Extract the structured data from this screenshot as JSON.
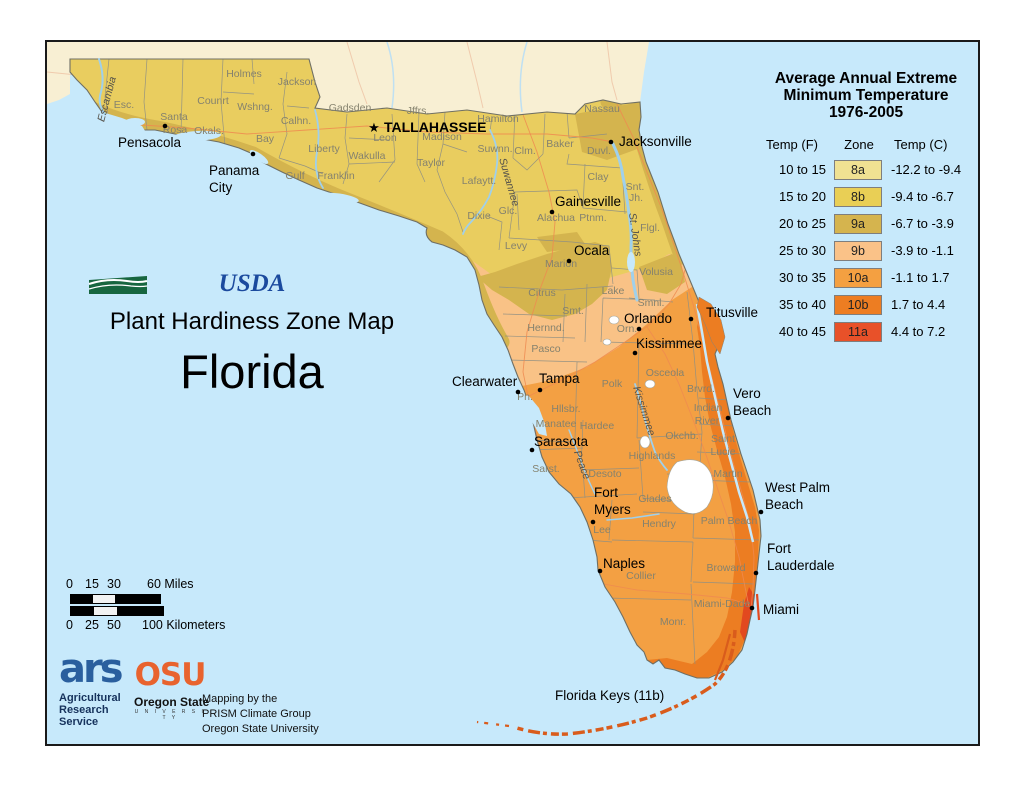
{
  "legend": {
    "title_lines": [
      "Average Annual Extreme",
      "Minimum Temperature",
      "1976-2005"
    ],
    "col_f": "Temp (F)",
    "col_zone": "Zone",
    "col_c": "Temp (C)",
    "rows": [
      {
        "f": "10 to 15",
        "zone": "8a",
        "c": "-12.2 to -9.4",
        "color": "#f0e192"
      },
      {
        "f": "15 to 20",
        "zone": "8b",
        "c": "-9.4 to -6.7",
        "color": "#e9cf55"
      },
      {
        "f": "20 to 25",
        "zone": "9a",
        "c": "-6.7 to -3.9",
        "color": "#d5b44e"
      },
      {
        "f": "25 to 30",
        "zone": "9b",
        "c": "-3.9 to -1.1",
        "color": "#fac288"
      },
      {
        "f": "30 to 35",
        "zone": "10a",
        "c": "-1.1 to 1.7",
        "color": "#f4a041"
      },
      {
        "f": "35 to 40",
        "zone": "10b",
        "c": "1.7 to 4.4",
        "color": "#ed7d22"
      },
      {
        "f": "40 to 45",
        "zone": "11a",
        "c": "4.4 to 7.2",
        "color": "#e85129"
      }
    ]
  },
  "titles": {
    "usda": "USDA",
    "map_title": "Plant Hardiness Zone Map",
    "state": "Florida"
  },
  "scalebar": {
    "miles": [
      "0",
      "15",
      "30",
      "60 Miles"
    ],
    "km": [
      "0",
      "25",
      "50",
      "100 Kilometers"
    ]
  },
  "credits": {
    "ars_glyph": "ars",
    "ars_lines": [
      "Agricultural",
      "Research",
      "Service"
    ],
    "osu": "OSU",
    "osu_sub": "Oregon State",
    "osu_univ": "U N I V E R S I T Y",
    "mapping_lines": [
      "Mapping by the",
      "PRISM Climate Group",
      "Oregon State University"
    ]
  },
  "map": {
    "colors": {
      "water": "#c7e9fb",
      "neighbor": "#f8efd3",
      "z8b": "#e9cd5f",
      "z9a": "#d4b44e",
      "z9b": "#f9c286",
      "z10a": "#f3a043",
      "z10b": "#ec7d22",
      "z11a": "#e2491f",
      "keys": "#d95c1c"
    },
    "capital": {
      "label": "TALLAHASSEE",
      "star": "★",
      "sx": 327,
      "sy": 90,
      "tx": 337,
      "ty": 90
    },
    "keys_label": {
      "label": "Florida Keys (11b)",
      "x": 508,
      "y": 658
    },
    "cities": [
      {
        "lines": [
          "Pensacola"
        ],
        "tx": 71,
        "ty": 105,
        "dot": {
          "x": 118,
          "y": 84
        }
      },
      {
        "lines": [
          "Panama",
          "City"
        ],
        "tx": 162,
        "ty": 133,
        "lh": 17,
        "dot": {
          "x": 206,
          "y": 112
        }
      },
      {
        "lines": [
          "Jacksonville"
        ],
        "tx": 572,
        "ty": 104,
        "dot": {
          "x": 564,
          "y": 100
        }
      },
      {
        "lines": [
          "Gainesville"
        ],
        "tx": 508,
        "ty": 164,
        "dot": {
          "x": 505,
          "y": 170
        }
      },
      {
        "lines": [
          "Ocala"
        ],
        "tx": 527,
        "ty": 213,
        "dot": {
          "x": 522,
          "y": 219
        }
      },
      {
        "lines": [
          "Titusville"
        ],
        "tx": 659,
        "ty": 275,
        "dot": {
          "x": 644,
          "y": 277
        }
      },
      {
        "lines": [
          "Orlando"
        ],
        "tx": 577,
        "ty": 281,
        "dot": {
          "x": 592,
          "y": 287
        }
      },
      {
        "lines": [
          "Kissimmee"
        ],
        "tx": 589,
        "ty": 306,
        "dot": {
          "x": 588,
          "y": 311
        }
      },
      {
        "lines": [
          "Clearwater"
        ],
        "tx": 405,
        "ty": 344,
        "dot": {
          "x": 471,
          "y": 350
        }
      },
      {
        "lines": [
          "Tampa"
        ],
        "tx": 492,
        "ty": 341,
        "dot": {
          "x": 493,
          "y": 348
        }
      },
      {
        "lines": [
          "Vero",
          "Beach"
        ],
        "tx": 686,
        "ty": 356,
        "lh": 17,
        "dot": {
          "x": 681,
          "y": 376
        }
      },
      {
        "lines": [
          "Sarasota"
        ],
        "tx": 487,
        "ty": 404,
        "dot": {
          "x": 485,
          "y": 408
        }
      },
      {
        "lines": [
          "Fort",
          "Myers"
        ],
        "tx": 547,
        "ty": 455,
        "lh": 17,
        "dot": {
          "x": 546,
          "y": 480
        }
      },
      {
        "lines": [
          "West Palm",
          "Beach"
        ],
        "tx": 718,
        "ty": 450,
        "lh": 17,
        "dot": {
          "x": 714,
          "y": 470
        }
      },
      {
        "lines": [
          "Naples"
        ],
        "tx": 556,
        "ty": 526,
        "dot": {
          "x": 553,
          "y": 529
        }
      },
      {
        "lines": [
          "Fort",
          "Lauderdale"
        ],
        "tx": 720,
        "ty": 511,
        "lh": 17,
        "dot": {
          "x": 709,
          "y": 531
        }
      },
      {
        "lines": [
          "Miami"
        ],
        "tx": 716,
        "ty": 572,
        "dot": {
          "x": 705,
          "y": 566
        }
      }
    ],
    "counties": [
      {
        "label": "Esc.",
        "x": 77,
        "y": 66
      },
      {
        "label": "Santa",
        "x": 127,
        "y": 78
      },
      {
        "label": "Rosa",
        "x": 128,
        "y": 91
      },
      {
        "label": "Okals.",
        "x": 162,
        "y": 92
      },
      {
        "label": "Counrt",
        "x": 166,
        "y": 62
      },
      {
        "label": "Holmes",
        "x": 197,
        "y": 35
      },
      {
        "label": "Wshng.",
        "x": 208,
        "y": 68
      },
      {
        "label": "Jackson",
        "x": 250,
        "y": 43
      },
      {
        "label": "Calhn.",
        "x": 249,
        "y": 82
      },
      {
        "label": "Gadsden",
        "x": 303,
        "y": 69
      },
      {
        "label": "Liberty",
        "x": 277,
        "y": 110
      },
      {
        "label": "Wakulla",
        "x": 320,
        "y": 117
      },
      {
        "label": "Bay",
        "x": 218,
        "y": 100
      },
      {
        "label": "Gulf",
        "x": 248,
        "y": 137
      },
      {
        "label": "Franklin",
        "x": 289,
        "y": 137
      },
      {
        "label": "Leon",
        "x": 338,
        "y": 99
      },
      {
        "label": "Jffrs.",
        "x": 371,
        "y": 72
      },
      {
        "label": "Madison",
        "x": 395,
        "y": 98
      },
      {
        "label": "Hamilton",
        "x": 451,
        "y": 80
      },
      {
        "label": "Taylor",
        "x": 384,
        "y": 124
      },
      {
        "label": "Suwnn.",
        "x": 448,
        "y": 110
      },
      {
        "label": "Clm.",
        "x": 478,
        "y": 112
      },
      {
        "label": "Lafaytt.",
        "x": 432,
        "y": 142
      },
      {
        "label": "Nassau",
        "x": 555,
        "y": 70
      },
      {
        "label": "Baker",
        "x": 513,
        "y": 105
      },
      {
        "label": "Duvl.",
        "x": 552,
        "y": 112
      },
      {
        "label": "Clay",
        "x": 551,
        "y": 138
      },
      {
        "label": "Snt.",
        "x": 588,
        "y": 148
      },
      {
        "label": "Jh.",
        "x": 589,
        "y": 159
      },
      {
        "label": "Dixie",
        "x": 432,
        "y": 177
      },
      {
        "label": "Glc.",
        "x": 461,
        "y": 172
      },
      {
        "label": "Alachua",
        "x": 509,
        "y": 179
      },
      {
        "label": "Ptnm.",
        "x": 546,
        "y": 179
      },
      {
        "label": "Flgl.",
        "x": 603,
        "y": 189
      },
      {
        "label": "Levy",
        "x": 469,
        "y": 207
      },
      {
        "label": "Marion",
        "x": 514,
        "y": 225
      },
      {
        "label": "Volusia",
        "x": 609,
        "y": 233
      },
      {
        "label": "Citrus",
        "x": 495,
        "y": 254
      },
      {
        "label": "Smt.",
        "x": 526,
        "y": 272
      },
      {
        "label": "Hernnd.",
        "x": 499,
        "y": 289
      },
      {
        "label": "Pasco",
        "x": 499,
        "y": 310
      },
      {
        "label": "Lake",
        "x": 566,
        "y": 252
      },
      {
        "label": "Smnl.",
        "x": 604,
        "y": 264
      },
      {
        "label": "Orn.",
        "x": 580,
        "y": 290
      },
      {
        "label": "Osceola",
        "x": 618,
        "y": 334
      },
      {
        "label": "Polk",
        "x": 565,
        "y": 345
      },
      {
        "label": "Brvrd.",
        "x": 654,
        "y": 350
      },
      {
        "label": "Indian",
        "x": 661,
        "y": 369
      },
      {
        "label": "River",
        "x": 660,
        "y": 382
      },
      {
        "label": "Hllsbr.",
        "x": 519,
        "y": 370
      },
      {
        "label": "Pn.",
        "x": 478,
        "y": 358
      },
      {
        "label": "Manatee",
        "x": 509,
        "y": 385
      },
      {
        "label": "Hardee",
        "x": 550,
        "y": 387
      },
      {
        "label": "Okchb.",
        "x": 635,
        "y": 397
      },
      {
        "label": "Saint",
        "x": 676,
        "y": 400
      },
      {
        "label": "Lucie",
        "x": 676,
        "y": 413
      },
      {
        "label": "Highlands",
        "x": 605,
        "y": 417
      },
      {
        "label": "Sarst.",
        "x": 499,
        "y": 430
      },
      {
        "label": "Desoto",
        "x": 558,
        "y": 435
      },
      {
        "label": "Glades",
        "x": 608,
        "y": 460
      },
      {
        "label": "Martin",
        "x": 681,
        "y": 435
      },
      {
        "label": "Hendry",
        "x": 612,
        "y": 485
      },
      {
        "label": "Palm Beach",
        "x": 682,
        "y": 482
      },
      {
        "label": "Lee",
        "x": 555,
        "y": 491
      },
      {
        "label": "Collier",
        "x": 594,
        "y": 537
      },
      {
        "label": "Broward",
        "x": 679,
        "y": 529
      },
      {
        "label": "Miami-Dade",
        "x": 675,
        "y": 565
      },
      {
        "label": "Monr.",
        "x": 626,
        "y": 583
      }
    ],
    "rivers": [
      {
        "label": "Escambia",
        "x": 63,
        "y": 58,
        "rot": -75
      },
      {
        "label": "Suwannee",
        "x": 459,
        "y": 141,
        "rot": 74
      },
      {
        "label": "St. Johns",
        "x": 585,
        "y": 193,
        "rot": 82
      },
      {
        "label": "Kissimmee",
        "x": 594,
        "y": 370,
        "rot": 72
      },
      {
        "label": "Peace",
        "x": 532,
        "y": 424,
        "rot": 70
      }
    ]
  }
}
